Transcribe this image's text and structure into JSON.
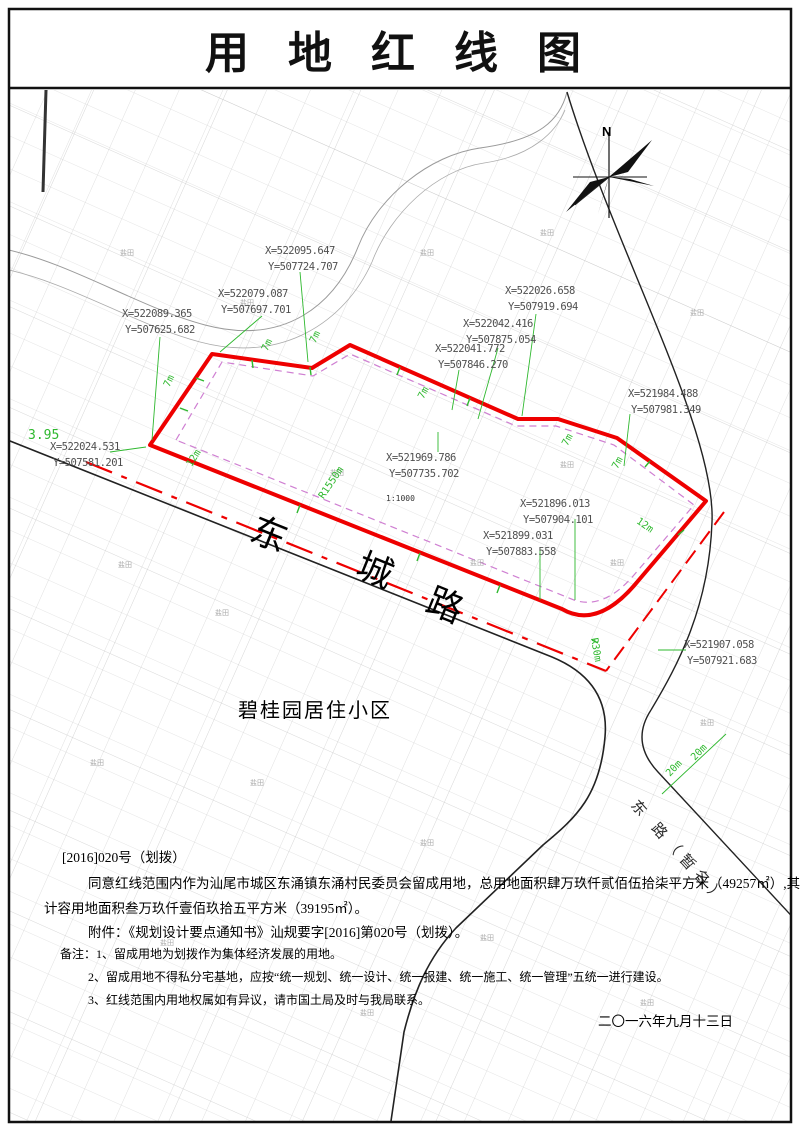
{
  "title": "用 地 红 线 图",
  "map": {
    "north_label": "N",
    "road_label": {
      "char1": "东",
      "char2": "城",
      "char3": "路"
    },
    "secondary_road_label": "东 路（暂名）",
    "district_label": "碧桂园居住小区",
    "scale_label": "1:1000",
    "partial_label": "3.95",
    "parcel_label": "盐田",
    "coordinates": [
      {
        "x": "X=522095.647",
        "y": "Y=507724.707"
      },
      {
        "x": "X=522079.087",
        "y": "Y=507697.701"
      },
      {
        "x": "X=522089.365",
        "y": "Y=507625.682"
      },
      {
        "x": "X=522026.658",
        "y": "Y=507919.694"
      },
      {
        "x": "X=522042.416",
        "y": "Y=507875.054"
      },
      {
        "x": "X=522041.772",
        "y": "Y=507846.270"
      },
      {
        "x": "X=521984.488",
        "y": "Y=507981.349"
      },
      {
        "x": "X=522024.531",
        "y": "Y=507581.201"
      },
      {
        "x": "X=521969.786",
        "y": "Y=507735.702"
      },
      {
        "x": "X=521896.013",
        "y": "Y=507904.101"
      },
      {
        "x": "X=521899.031",
        "y": "Y=507883.558"
      },
      {
        "x": "X=521907.058",
        "y": "Y=507921.683"
      }
    ],
    "dimensions": [
      {
        "label": "7m"
      },
      {
        "label": "7m"
      },
      {
        "label": "7m"
      },
      {
        "label": "7m"
      },
      {
        "label": "7m"
      },
      {
        "label": "7m"
      },
      {
        "label": "12m"
      },
      {
        "label": "12m"
      },
      {
        "label": "R1550m"
      },
      {
        "label": "R30m"
      },
      {
        "label": "20m"
      },
      {
        "label": "20m"
      }
    ]
  },
  "notes": {
    "line1": "[2016]020号（划拨）",
    "line2": "同意红线范围内作为汕尾市城区东涌镇东涌村民委员会留成用地，总用地面积肆万玖仟贰佰伍拾柒平方米（49257㎡）,其中",
    "line3": "计容用地面积叁万玖仟壹佰玖拾五平方米（39195㎡）。",
    "line4": "附件：《规划设计要点通知书》汕规要字[2016]第020号（划拨）。",
    "line5": "备注：1、留成用地为划拨作为集体经济发展的用地。",
    "line6": "2、留成用地不得私分宅基地，应按“统一规划、统一设计、统一报建、统一施工、统一管理”五统一进行建设。",
    "line7": "3、红线范围内用地权属如有异议，请市国土局及时与我局联系。",
    "date": "二〇一六年九月十三日"
  },
  "colors": {
    "red_line": "#ee0000",
    "setback_line": "#cf7fd2",
    "annotation_green": "#2eb82e",
    "road_black": "#222222",
    "mesh_gray": "#cccccc"
  }
}
